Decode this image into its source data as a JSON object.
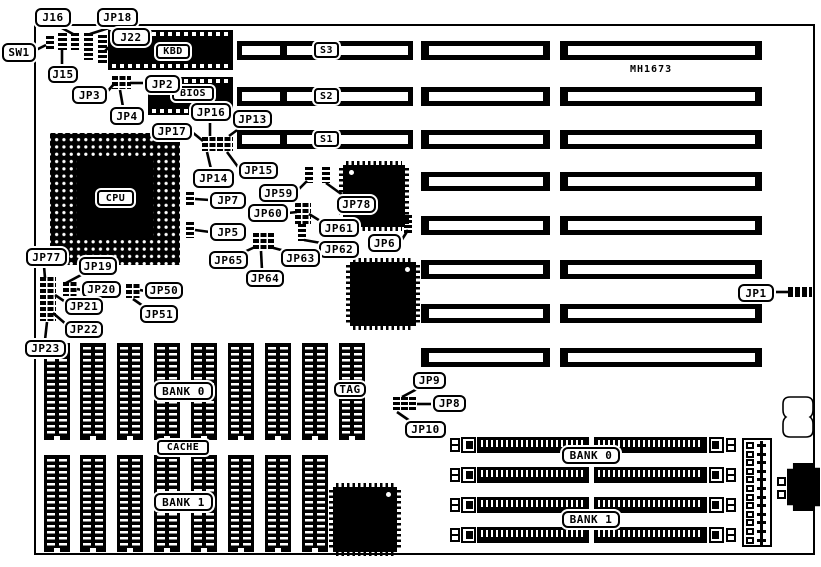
{
  "model_label": "MH1673",
  "slot_labels": [
    "S3",
    "S2",
    "S1"
  ],
  "chip_labels": {
    "kbd": "KBD",
    "bios": "BIOS",
    "cpu": "CPU"
  },
  "cache_labels": {
    "bank0": "BANK 0",
    "tag": "TAG",
    "cache": "CACHE",
    "bank1": "BANK 1"
  },
  "simm_labels": {
    "bank0": "BANK 0",
    "bank1": "BANK 1"
  },
  "callouts": [
    {
      "id": "sw1",
      "label": "SW1"
    },
    {
      "id": "j16",
      "label": "J16"
    },
    {
      "id": "jp18",
      "label": "JP18"
    },
    {
      "id": "j22",
      "label": "J22"
    },
    {
      "id": "j15",
      "label": "J15"
    },
    {
      "id": "jp3",
      "label": "JP3"
    },
    {
      "id": "jp2",
      "label": "JP2"
    },
    {
      "id": "jp4",
      "label": "JP4"
    },
    {
      "id": "jp16",
      "label": "JP16"
    },
    {
      "id": "jp13",
      "label": "JP13"
    },
    {
      "id": "jp17",
      "label": "JP17"
    },
    {
      "id": "jp14",
      "label": "JP14"
    },
    {
      "id": "jp15",
      "label": "JP15"
    },
    {
      "id": "jp59",
      "label": "JP59"
    },
    {
      "id": "jp78",
      "label": "JP78"
    },
    {
      "id": "jp7",
      "label": "JP7"
    },
    {
      "id": "jp60",
      "label": "JP60"
    },
    {
      "id": "jp61",
      "label": "JP61"
    },
    {
      "id": "jp5",
      "label": "JP5"
    },
    {
      "id": "jp62",
      "label": "JP62"
    },
    {
      "id": "jp6",
      "label": "JP6"
    },
    {
      "id": "jp65",
      "label": "JP65"
    },
    {
      "id": "jp63",
      "label": "JP63"
    },
    {
      "id": "jp64",
      "label": "JP64"
    },
    {
      "id": "jp77",
      "label": "JP77"
    },
    {
      "id": "jp19",
      "label": "JP19"
    },
    {
      "id": "jp20",
      "label": "JP20"
    },
    {
      "id": "jp50",
      "label": "JP50"
    },
    {
      "id": "jp21",
      "label": "JP21"
    },
    {
      "id": "jp51",
      "label": "JP51"
    },
    {
      "id": "jp22",
      "label": "JP22"
    },
    {
      "id": "jp23",
      "label": "JP23"
    },
    {
      "id": "jp9",
      "label": "JP9"
    },
    {
      "id": "jp8",
      "label": "JP8"
    },
    {
      "id": "jp10",
      "label": "JP10"
    },
    {
      "id": "jp1",
      "label": "JP1"
    }
  ]
}
